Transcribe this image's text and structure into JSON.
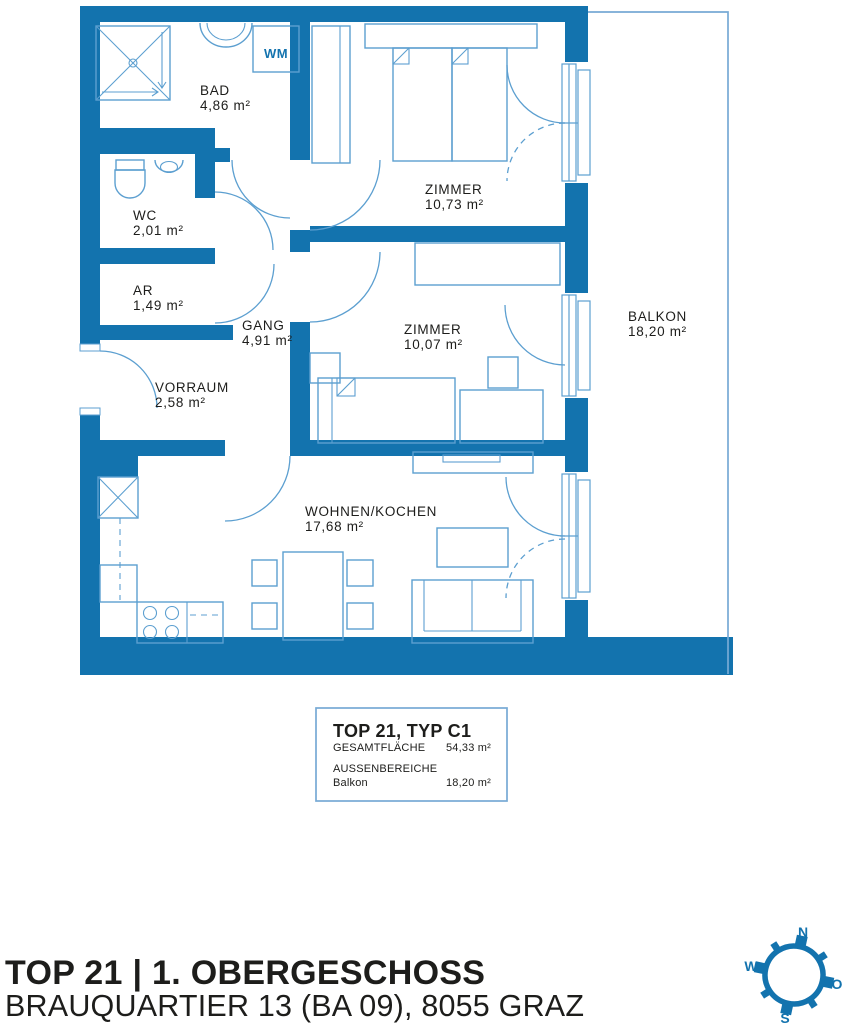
{
  "plan": {
    "rooms": {
      "bad": {
        "name": "BAD",
        "area": "4,86 m²"
      },
      "wc": {
        "name": "WC",
        "area": "2,01 m²"
      },
      "ar": {
        "name": "AR",
        "area": "1,49 m²"
      },
      "gang": {
        "name": "GANG",
        "area": "4,91 m²"
      },
      "vorraum": {
        "name": "VORRAUM",
        "area": "2,58 m²"
      },
      "zimmer1": {
        "name": "ZIMMER",
        "area": "10,73 m²"
      },
      "zimmer2": {
        "name": "ZIMMER",
        "area": "10,07 m²"
      },
      "wohnen": {
        "name": "WOHNEN/KOCHEN",
        "area": "17,68 m²"
      },
      "balkon": {
        "name": "BALKON",
        "area": "18,20 m²"
      }
    },
    "appliances": {
      "wm": "WM"
    }
  },
  "legend": {
    "title": "TOP 21, TYP C1",
    "total_label": "GESAMTFLÄCHE",
    "total_value": "54,33 m²",
    "outdoor_label": "AUSSENBEREICHE",
    "outdoor_item_name": "Balkon",
    "outdoor_item_value": "18,20 m²"
  },
  "footer": {
    "title": "TOP 21 | 1. OBERGESCHOSS",
    "subtitle": "BRAUQUARTIER 13 (BA 09), 8055 GRAZ"
  },
  "compass": {
    "n": "N",
    "o": "O",
    "s": "S",
    "w": "W"
  },
  "colors": {
    "wall": "#1373ae",
    "line": "#5c9fd0",
    "text": "#1d1d1b"
  }
}
